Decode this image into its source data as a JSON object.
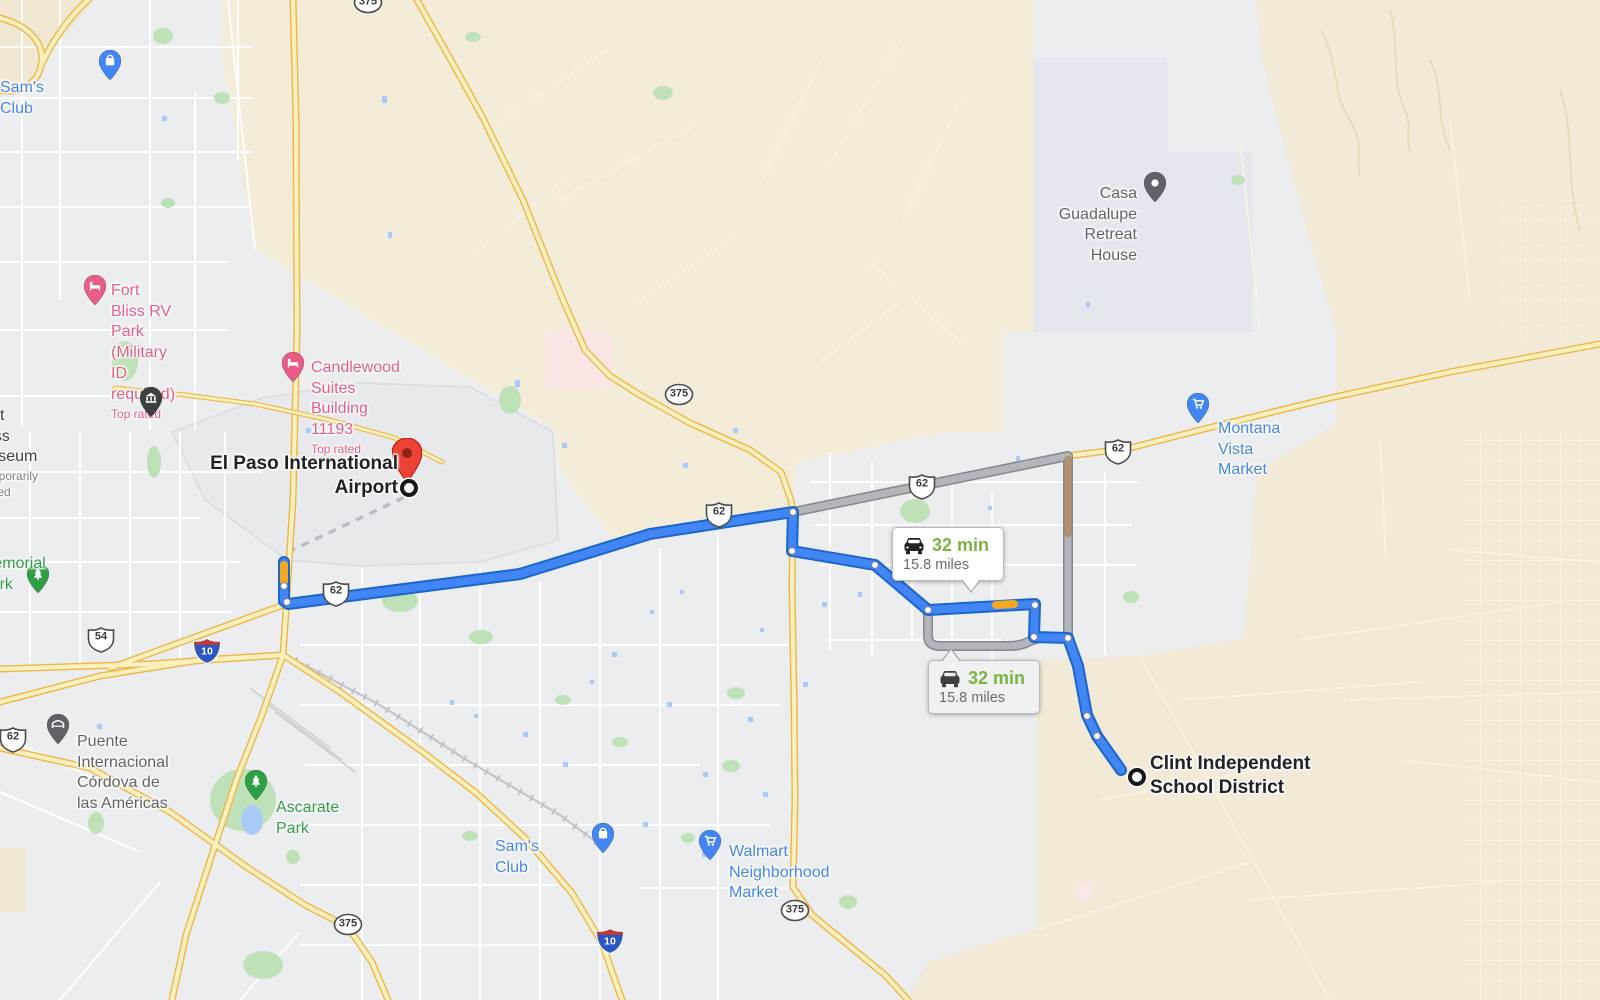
{
  "route_bubbles": {
    "primary": {
      "duration": "32 min",
      "distance": "15.8 miles"
    },
    "alternate": {
      "duration": "32 min",
      "distance": "15.8 miles"
    }
  },
  "endpoints": {
    "origin": {
      "label": "El Paso International\nAirport"
    },
    "destination": {
      "label": "Clint Independent\nSchool District"
    }
  },
  "colors": {
    "route_blue": "#4285f4",
    "route_blue_border": "#1a66cc",
    "alt_gray": "#b2b6bb",
    "alt_gray_border": "#84888c",
    "traffic_orange": "#f6a821",
    "traffic_brown": "#b2916e",
    "duration_green": "#7cb342",
    "poi_blue": "#4285f4",
    "poi_pink": "#e85c85",
    "poi_green": "#2f9e44",
    "pin_slate": "#677b8c",
    "urban": "#ebedee",
    "tan": "#f3ecd9"
  },
  "neighborhoods": [
    {
      "text": "MILAGRO HILLS",
      "x": 186,
      "y": 9
    },
    {
      "text": "CASTNER\nHEIGHTS",
      "x": 137,
      "y": 98
    },
    {
      "text": "ANGEL'S\nTRIANGLE",
      "x": 122,
      "y": 172
    },
    {
      "text": "MORNINGSIDE\nHEIGHTS",
      "x": 68,
      "y": 452
    },
    {
      "text": "CIELO\nVISTA EAST",
      "x": 397,
      "y": 608
    },
    {
      "text": "EAST EL PASO",
      "x": 527,
      "y": 629
    },
    {
      "text": "PICO NORTE",
      "x": 538,
      "y": 653
    },
    {
      "text": "SANDY CREEK",
      "x": 690,
      "y": 690
    },
    {
      "text": "VISTA DEL\nSOL EAST",
      "x": 628,
      "y": 714
    },
    {
      "text": "VISTA HILLS",
      "x": 634,
      "y": 760
    },
    {
      "text": "MONTWOOD",
      "x": 757,
      "y": 750
    },
    {
      "text": "SUN RIDGE\nSOUTH",
      "x": 845,
      "y": 712
    },
    {
      "text": "MONTWOOD\nHEIGHTS",
      "x": 828,
      "y": 776
    },
    {
      "text": "EL DORADO\nWEST",
      "x": 809,
      "y": 524
    },
    {
      "text": "SAN LORENZO",
      "x": 160,
      "y": 881
    },
    {
      "text": "MISSION VALLEY",
      "x": 425,
      "y": 895
    },
    {
      "text": "STONE RIDGE",
      "x": 674,
      "y": 899
    },
    {
      "text": "RANCHOS\nDEL SOL",
      "x": 745,
      "y": 963
    },
    {
      "text": "PARTIDO SENECÚ",
      "x": 246,
      "y": 982
    }
  ],
  "places": [
    {
      "text": "Biggs Field",
      "x": 345,
      "y": 253
    },
    {
      "text": "Butterfield",
      "x": 1484,
      "y": 337
    },
    {
      "text": "Homestead\nMeadows\nNorth",
      "x": 1155,
      "y": 218
    },
    {
      "text": "Homestead\nMeadows\nSouth",
      "x": 1196,
      "y": 452
    },
    {
      "text": "Covenant Specia\nProjects - CSP",
      "x": 1533,
      "y": 158
    }
  ],
  "pois": [
    {
      "name": "sams-club-north",
      "text": "Sam's Club",
      "color": "#4285f4",
      "type": "bag",
      "pin_x": 110,
      "pin_y": 80,
      "x": 0,
      "y": 57,
      "align": "left"
    },
    {
      "name": "fort-bliss-rv-park",
      "text": "Fort Bliss RV Park\n(Military ID required)",
      "sub": "Top rated",
      "color": "#e85c85",
      "type": "bed",
      "pin_x": 95,
      "pin_y": 305,
      "x": 111,
      "y": 260,
      "align": "left"
    },
    {
      "name": "candlewood-suites",
      "text": "Candlewood Suites\nBuilding 11193",
      "sub": "Top rated",
      "color": "#e85c85",
      "type": "bed",
      "pin_x": 293,
      "pin_y": 382,
      "x": 311,
      "y": 337,
      "align": "left"
    },
    {
      "name": "fort-bliss-museum",
      "text": "Fort Bliss Museum",
      "sub": "Temporarily closed",
      "color": "#3c4043",
      "sub_color": "#7d8288",
      "type": "museum",
      "pin_x": 151,
      "pin_y": 417,
      "x": -24,
      "y": 385,
      "align": "left"
    },
    {
      "name": "memorial-park",
      "text": "Memorial Park",
      "color": "#2f9e44",
      "type": "tree",
      "pin_x": 38,
      "pin_y": 593,
      "x": -20,
      "y": 533,
      "align": "left"
    },
    {
      "name": "puente-internacional",
      "text": "Puente Internacional\nCórdova de las Américas",
      "color": "#5f6368",
      "type": "bridge",
      "pin_x": 58,
      "pin_y": 744,
      "x": 77,
      "y": 711,
      "align": "left"
    },
    {
      "name": "ascarate-park",
      "text": "Ascarate Park",
      "color": "#2f9e44",
      "type": "tree",
      "pin_x": 256,
      "pin_y": 800,
      "x": 276,
      "y": 777,
      "align": "left"
    },
    {
      "name": "sams-club-south",
      "text": "Sam's Club",
      "color": "#4285f4",
      "type": "bag",
      "pin_x": 603,
      "pin_y": 853,
      "x": 495,
      "y": 816,
      "align": "left"
    },
    {
      "name": "walmart-market",
      "text": "Walmart\nNeighborhood Market",
      "color": "#4285f4",
      "type": "cart",
      "pin_x": 710,
      "pin_y": 860,
      "x": 729,
      "y": 821,
      "align": "left"
    },
    {
      "name": "montana-vista-market",
      "text": "Montana Vista Market",
      "color": "#4285f4",
      "type": "cart",
      "pin_x": 1198,
      "pin_y": 423,
      "x": 1218,
      "y": 398,
      "align": "left"
    },
    {
      "name": "casa-guadalupe",
      "text": "Casa Guadalupe\nRetreat House",
      "color": "#5f6368",
      "type": "dot",
      "pin_x": 1155,
      "pin_y": 202,
      "x": 1137,
      "y": 163,
      "align": "right"
    }
  ],
  "shields": [
    {
      "kind": "us",
      "num": "62",
      "x": 13,
      "y": 740
    },
    {
      "kind": "us",
      "num": "62",
      "x": 336,
      "y": 594
    },
    {
      "kind": "us",
      "num": "62",
      "x": 719,
      "y": 515
    },
    {
      "kind": "us",
      "num": "62",
      "x": 922,
      "y": 487
    },
    {
      "kind": "us",
      "num": "62",
      "x": 1118,
      "y": 452
    },
    {
      "kind": "us",
      "num": "54",
      "x": 101,
      "y": 640
    },
    {
      "kind": "circle",
      "num": "375",
      "x": 679,
      "y": 395
    },
    {
      "kind": "circle",
      "num": "375",
      "x": 348,
      "y": 925
    },
    {
      "kind": "circle",
      "num": "375",
      "x": 795,
      "y": 911
    },
    {
      "kind": "circle",
      "num": "375",
      "x": 368,
      "y": 3
    },
    {
      "kind": "interstate",
      "num": "10",
      "x": 207,
      "y": 651
    },
    {
      "kind": "interstate",
      "num": "10",
      "x": 610,
      "y": 941
    }
  ]
}
